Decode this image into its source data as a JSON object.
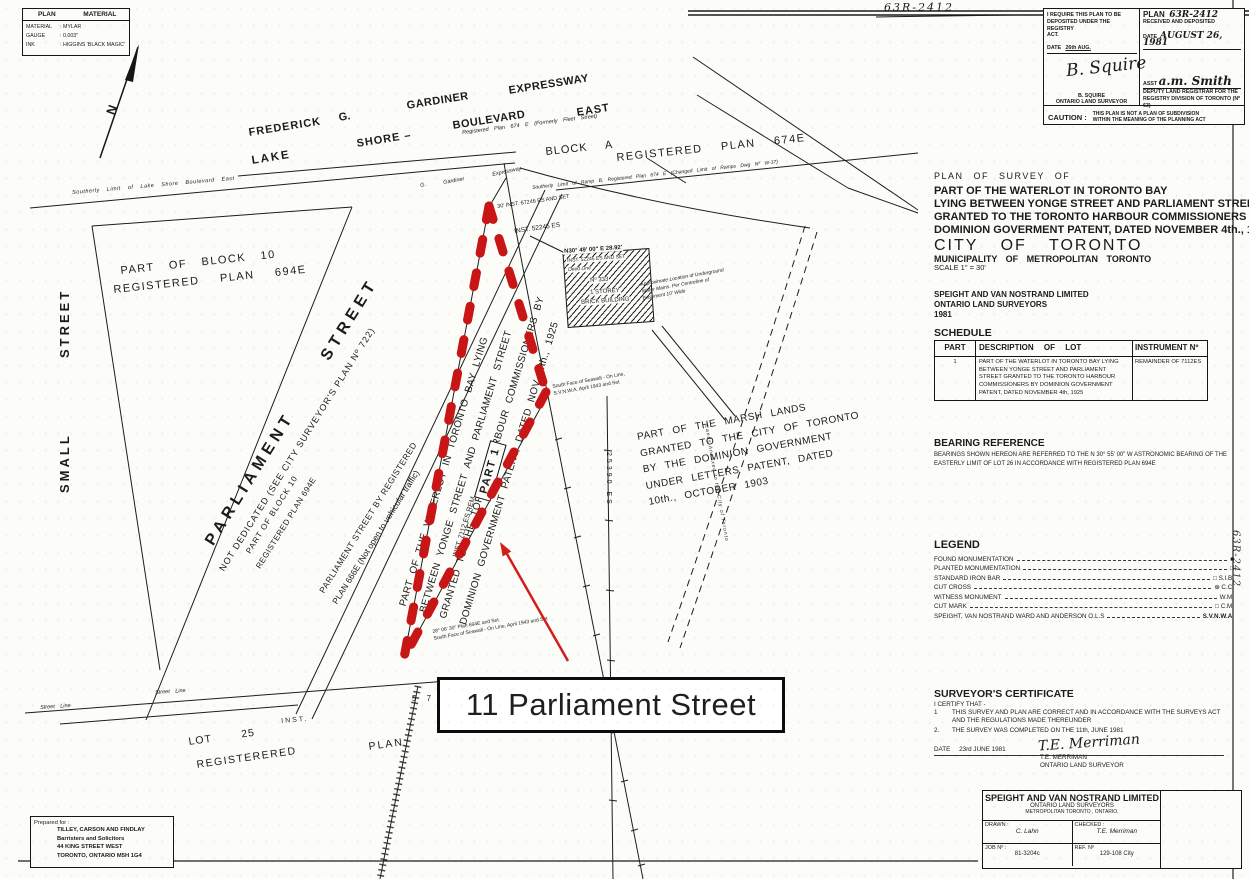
{
  "sheet": {
    "number_top": "63R-2412",
    "number_side": "63R-2412"
  },
  "colors": {
    "highlight_red": "#c81515",
    "arrow_red": "#d31c1c",
    "ink": "#1b1b1b",
    "paper": "#fcfcf9"
  },
  "material_box": {
    "col1": "PLAN",
    "col2": "MATERIAL",
    "rows": [
      {
        "label": "MATERIAL",
        "value": "MYLAR"
      },
      {
        "label": "GAUGE",
        "value": "0.003\""
      },
      {
        "label": "INK",
        "value": "HIGGINS 'BLACK MAGIC'"
      }
    ]
  },
  "registry_box": {
    "left": {
      "line1": "I REQUIRE THIS PLAN TO BE",
      "line2": "DEPOSITED UNDER THE REGISTRY",
      "line3": "ACT.",
      "date_label": "DATE",
      "date_value": "26th AUG.",
      "signature": "B. Squire",
      "name": "B. SQUIRE",
      "title": "ONTARIO LAND SURVEYOR"
    },
    "right": {
      "plan_label": "PLAN",
      "plan_number": "63R-2412",
      "received": "RECEIVED AND DEPOSITED",
      "date_label": "DATE",
      "date_value": "AUGUST 26, 1981",
      "asst_label": "ASST",
      "signature": "a.m. Smith",
      "title1": "DEPUTY LAND REGISTRAR FOR THE",
      "title2": "REGISTRY DIVISION OF TORONTO (Nº 63)"
    },
    "caution_label": "CAUTION :",
    "caution1": "THIS PLAN IS NOT A PLAN OF SUBDIVISION",
    "caution2": "WITHIN THE MEANING OF THE PLANNING ACT"
  },
  "title_block": {
    "line1": "PLAN OF SURVEY OF",
    "line2": "PART OF THE WATERLOT IN TORONTO BAY",
    "line3": "LYING BETWEEN YONGE STREET AND PARLIAMENT STREET",
    "line4": "GRANTED TO THE TORONTO HARBOUR COMMISSIONERS BY",
    "line5": "DOMINION GOVERMENT PATENT, DATED NOVEMBER 4th., 1925.",
    "city": "CITY OF TORONTO",
    "municipality": "MUNICIPALITY OF METROPOLITAN TORONTO",
    "scale": "SCALE 1\" = 30'",
    "firm": "SPEIGHT AND VAN NOSTRAND LIMITED",
    "firm2": "ONTARIO LAND SURVEYORS",
    "year": "1981"
  },
  "schedule": {
    "title": "SCHEDULE",
    "headers": [
      "PART",
      "DESCRIPTION OF LOT",
      "INSTRUMENT Nº"
    ],
    "row": {
      "part": "1",
      "description": "PART OF THE WATERLOT IN TORONTO BAY LYING BETWEEN YONGE STREET AND PARLIAMENT STREET GRANTED TO THE TORONTO HARBOUR COMMISSIONERS BY DOMINION GOVERNMENT PATENT, DATED NOVEMBER 4th, 1925",
      "instrument": "REMAINDER OF 7112ES"
    }
  },
  "bearing": {
    "title": "BEARING REFERENCE",
    "text": "BEARINGS SHOWN HEREON ARE REFERRED TO THE N 30° 55' 00\" W ASTRONOMIC BEARING OF THE EASTERLY LIMIT OF LOT 26 IN ACCORDANCE WITH REGISTERED PLAN 694E"
  },
  "legend": {
    "title": "LEGEND",
    "items": [
      {
        "label": "FOUND MONUMENTATION",
        "symbol": "■"
      },
      {
        "label": "PLANTED MONUMENTATION",
        "symbol": "□"
      },
      {
        "label": "STANDARD IRON BAR",
        "symbol": "□ S.I.B."
      },
      {
        "label": "CUT CROSS",
        "symbol": "⊕ C.C."
      },
      {
        "label": "WITNESS MONUMENT",
        "symbol": "W.M."
      },
      {
        "label": "CUT MARK",
        "symbol": "□ C.M."
      },
      {
        "label": "SPEIGHT, VAN NOSTRAND WARD AND ANDERSON O.L.S",
        "symbol": "S.V.N.W.A."
      }
    ]
  },
  "certificate": {
    "title": "SURVEYOR'S CERTIFICATE",
    "intro": "I CERTIFY THAT -",
    "item1_num": "1",
    "item1a": "THIS SURVEY AND PLAN ARE CORRECT AND IN ACCORDANCE WITH THE SURVEYS ACT",
    "item1b": "AND THE REGULATIONS MADE THEREUNDER",
    "item2_num": "2.",
    "item2": "THE SURVEY WAS COMPLETED ON THE 11th, JUNE 1981",
    "date_label": "DATE",
    "date_value": "23rd JUNE 1981",
    "signature": "T.E. Merriman",
    "name": "T.E. MERRIMAN",
    "title_line": "ONTARIO LAND SURVEYOR"
  },
  "firm_box": {
    "name": "SPEIGHT AND VAN NOSTRAND LIMITED",
    "line2": "ONTARIO LAND SURVEYORS",
    "line3": "METROPOLITAN TORONTO , ONTARIO.",
    "drawn_label": "DRAWN :",
    "drawn_value": "C. Lahn",
    "checked_label": "CHECKED :",
    "checked_value": "T.E. Merriman",
    "job_label": "JOB Nº :",
    "job_value": "81-3204c",
    "ref_label": "REF. Nº",
    "ref_value": "129-108 City"
  },
  "prepared_box": {
    "label": "Prepared for :",
    "line1": "TILLEY, CARSON AND FINDLAY",
    "line2": "Barristers and Solicitors",
    "line3": "44 KING STREET WEST",
    "line4": "TORONTO, ONTARIO M5H 1G4"
  },
  "annotation": {
    "label": "11 Parliament Street"
  },
  "map": {
    "labels": {
      "north": "N",
      "frederick": "FREDERICK",
      "g": "G.",
      "gardiner": "GARDINER",
      "expressway": "EXPRESSWAY",
      "lake": "LAKE",
      "shore": "SHORE  –",
      "boulevard": "BOULEVARD",
      "east": "EAST",
      "block_a": "BLOCK A",
      "reg_plan_674e": "REGISTERED PLAN 674E",
      "reg_plan_674e_small": "Registered Plan 674 E (Formerly Fleet Street)",
      "southerly_lsb": "Southerly Limit of Lake Shore Boulevard East",
      "southerly_ramp": "Southerly Limit of Ramp B, Registered Plan 674 E (Changed Limit of Ramps Dwg Nº W-17)",
      "g_small": "G.",
      "gardiner_small": "Gardiner",
      "expressway_small": "Expressway",
      "part_block10_1": "PART OF BLOCK 10",
      "part_block10_2": "REGISTERED PLAN 694E",
      "street_v": "STREET",
      "small_v": "SMALL",
      "parliament": "PARLIAMENT  STREET",
      "not_dedicated": "NOT DEDICATED (SEE CITY SURVEYOR'S PLAN Nº 722)",
      "part_block10b_1": "PART OF BLOCK 10",
      "part_block10b_2": "REGISTERED PLAN 694E",
      "parl666_1": "PARLIAMENT STREET BY REGISTERED",
      "parl666_2": "PLAN 666E (Not open to vehicular traffic)",
      "waterlot_1": "PART OF THE WATERLOT IN TORONTO BAY LYING",
      "waterlot_2": "BETWEEN YONGE STREET AND PARLIAMENT STREET",
      "waterlot_3": "GRANTED TO THE TORONTO HARBOUR COMMISSIONERS BY",
      "waterlot_4": "DOMINION GOVERNMENT PATENT, DATED NOV. 4th., 1925",
      "part1": "PART 1",
      "inst_rem": "INST. 7112 ES  REM.",
      "marsh_1": "PART OF THE MARSH LANDS",
      "marsh_2": "GRANTED TO THE CITY OF TORONTO",
      "marsh_3": "BY THE DOMINION GOVERNMENT",
      "marsh_4": "UNDER LETTERS PATENT, DATED",
      "marsh_5": "10th., OCTOBER 1903",
      "inst_25390": "25390 ES",
      "lands": "Lands Annexed to the City of Toronto",
      "lot25": "LOT  25",
      "registerered": "REGISTERERED",
      "plan_word": "PLAN",
      "inst_word": "INST.",
      "five_seven": "5 7",
      "street_line": "Street Line",
      "street_line2": "Street Line",
      "bldg_bearing": "N30° 49' 00\" E  28.92'",
      "bldg_inst": "INST. 52245 ES AND SET",
      "deed_line": "Deed Line",
      "no333": "Nº 333",
      "storey": "1 STOREY",
      "brick": "BRICK BUILDING",
      "inst52245": "INST. 52245 ES",
      "inst_apex": "30' INST. 67246 ES AND SET",
      "wm_1": "Approximate Location of Underground",
      "wm_2": "Water Mains. Per Centreline of",
      "wm_3": "Easement 10' Wide",
      "seawall_1": "South Face of Seawall - On Line,",
      "seawall_2": "S.V.N.W.A. April 1943 and Set",
      "corner_1": "28° 06' 30\"   Plan 694E and Set",
      "corner_2": "South Face of Seawall - On Line, April 1943 and Set"
    }
  }
}
